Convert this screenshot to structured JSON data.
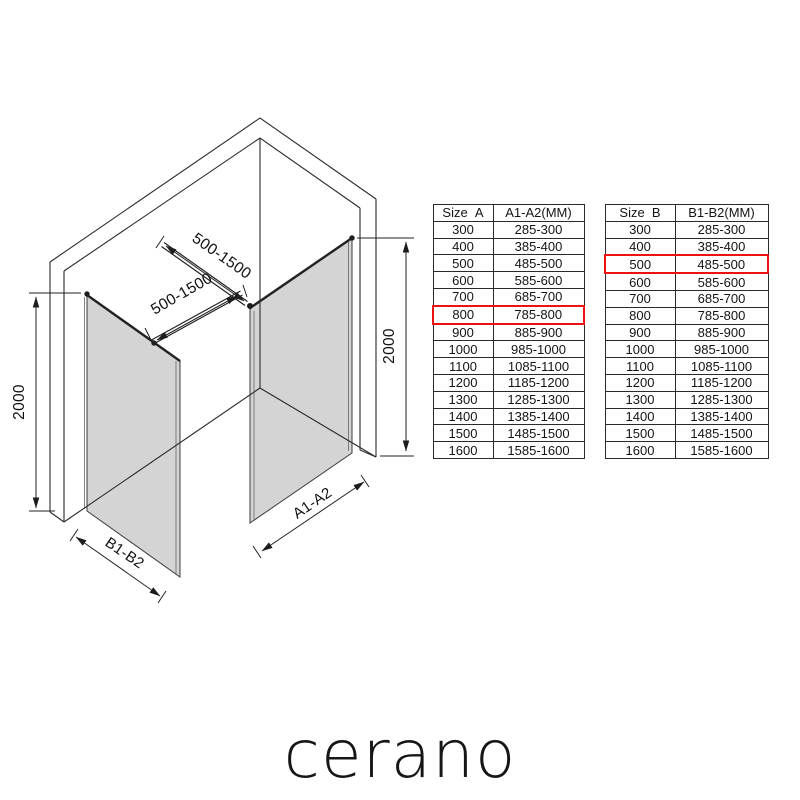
{
  "diagram": {
    "labels": {
      "bar_a_dim": "500-1500",
      "bar_b_dim": "500-1500",
      "height_left": "2000",
      "height_right": "2000",
      "panel_a": "A1-A2",
      "panel_b": "B1-B2"
    }
  },
  "colors": {
    "highlight_red": "#ee1111",
    "glass_gray": "#d4d4d4",
    "line_dark": "#2c2c2c"
  },
  "tables": [
    {
      "name": "size-a",
      "headers": [
        "Size  A",
        "A1-A2(MM)"
      ],
      "rows": [
        [
          "300",
          "285-300"
        ],
        [
          "400",
          "385-400"
        ],
        [
          "500",
          "485-500"
        ],
        [
          "600",
          "585-600"
        ],
        [
          "700",
          "685-700"
        ],
        [
          "800",
          "785-800"
        ],
        [
          "900",
          "885-900"
        ],
        [
          "1000",
          "985-1000"
        ],
        [
          "1100",
          "1085-1100"
        ],
        [
          "1200",
          "1185-1200"
        ],
        [
          "1300",
          "1285-1300"
        ],
        [
          "1400",
          "1385-1400"
        ],
        [
          "1500",
          "1485-1500"
        ],
        [
          "1600",
          "1585-1600"
        ]
      ],
      "highlight_row_index": 5
    },
    {
      "name": "size-b",
      "headers": [
        "Size  B",
        "B1-B2(MM)"
      ],
      "rows": [
        [
          "300",
          "285-300"
        ],
        [
          "400",
          "385-400"
        ],
        [
          "500",
          "485-500"
        ],
        [
          "600",
          "585-600"
        ],
        [
          "700",
          "685-700"
        ],
        [
          "800",
          "785-800"
        ],
        [
          "900",
          "885-900"
        ],
        [
          "1000",
          "985-1000"
        ],
        [
          "1100",
          "1085-1100"
        ],
        [
          "1200",
          "1185-1200"
        ],
        [
          "1300",
          "1285-1300"
        ],
        [
          "1400",
          "1385-1400"
        ],
        [
          "1500",
          "1485-1500"
        ],
        [
          "1600",
          "1585-1600"
        ]
      ],
      "highlight_row_index": 2
    }
  ],
  "brand": {
    "logo_text": "cerano"
  }
}
